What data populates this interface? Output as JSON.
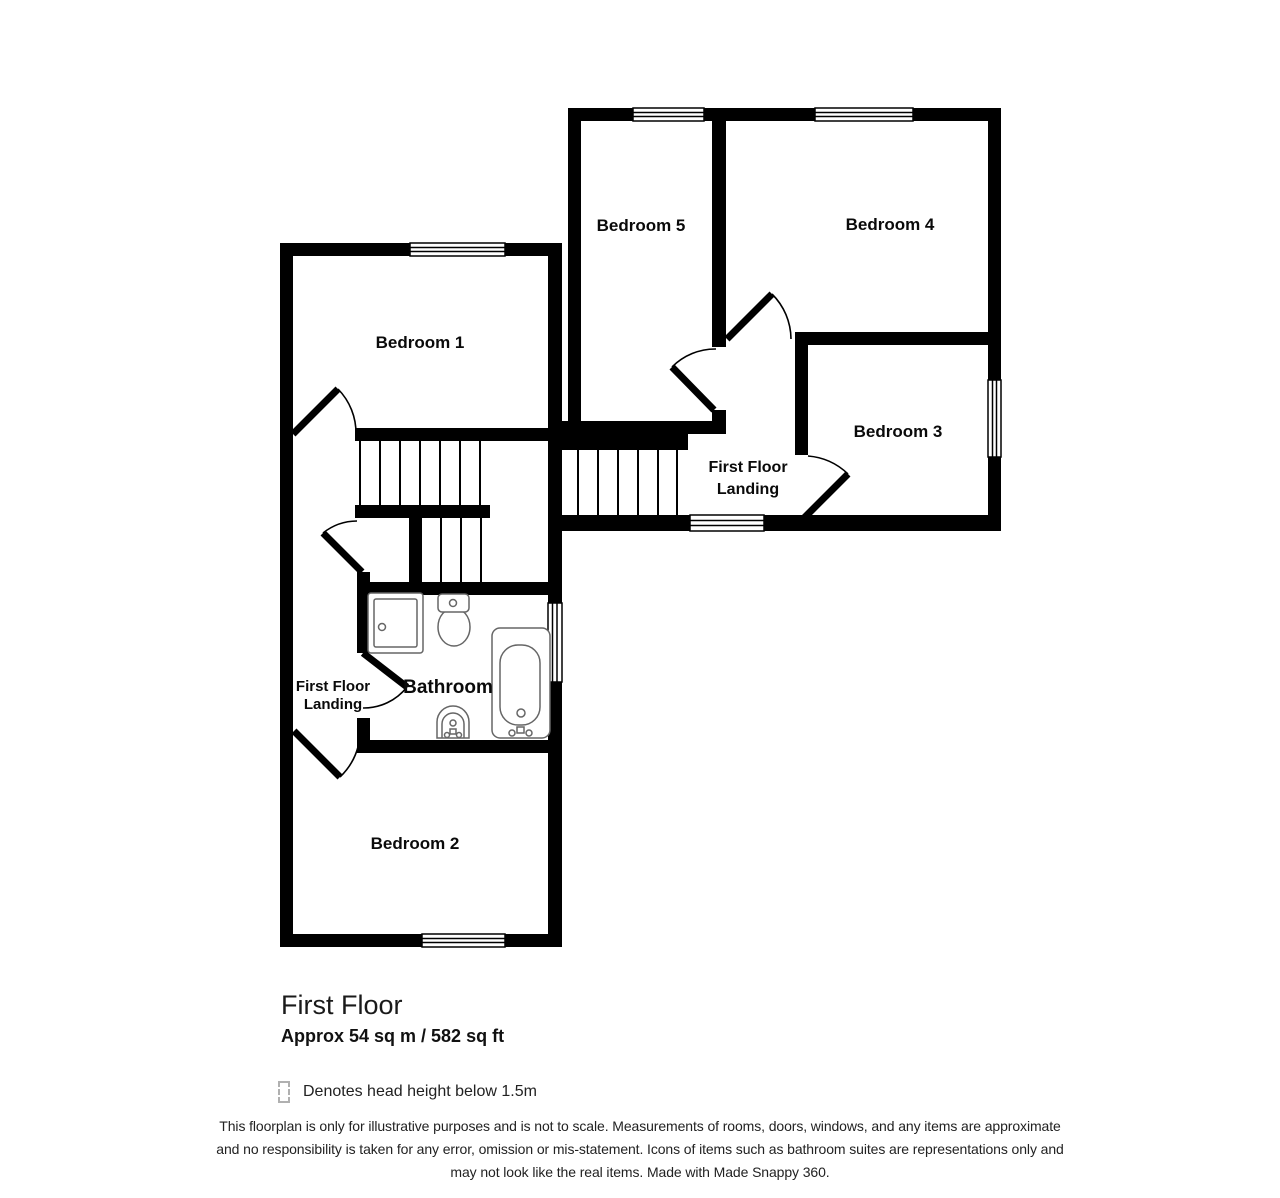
{
  "floorplan": {
    "rooms": {
      "bedroom1": "Bedroom 1",
      "bedroom2": "Bedroom 2",
      "bedroom3": "Bedroom 3",
      "bedroom4": "Bedroom 4",
      "bedroom5": "Bedroom 5",
      "bathroom": "Bathroom",
      "landing_right": {
        "line1": "First Floor",
        "line2": "Landing"
      },
      "landing_left": {
        "line1": "First Floor",
        "line2": "Landing"
      }
    },
    "footer": {
      "title": "First Floor",
      "area": "Approx 54 sq m / 582 sq ft",
      "legend_label": "Denotes head height below 1.5m",
      "disclaimer": {
        "line1": "This floorplan is only for illustrative purposes and is not to scale. Measurements of rooms, doors, windows, and any items are approximate",
        "line2": "and no responsibility is taken for any error, omission or mis-statement. Icons of items such as bathroom suites are representations only and",
        "line3": "may not look like the real items. Made with Made Snappy 360."
      }
    },
    "colors": {
      "wall": "#000000",
      "fixture_outline": "#666666",
      "legend_dash": "#b0b0b0",
      "background": "#ffffff"
    }
  }
}
